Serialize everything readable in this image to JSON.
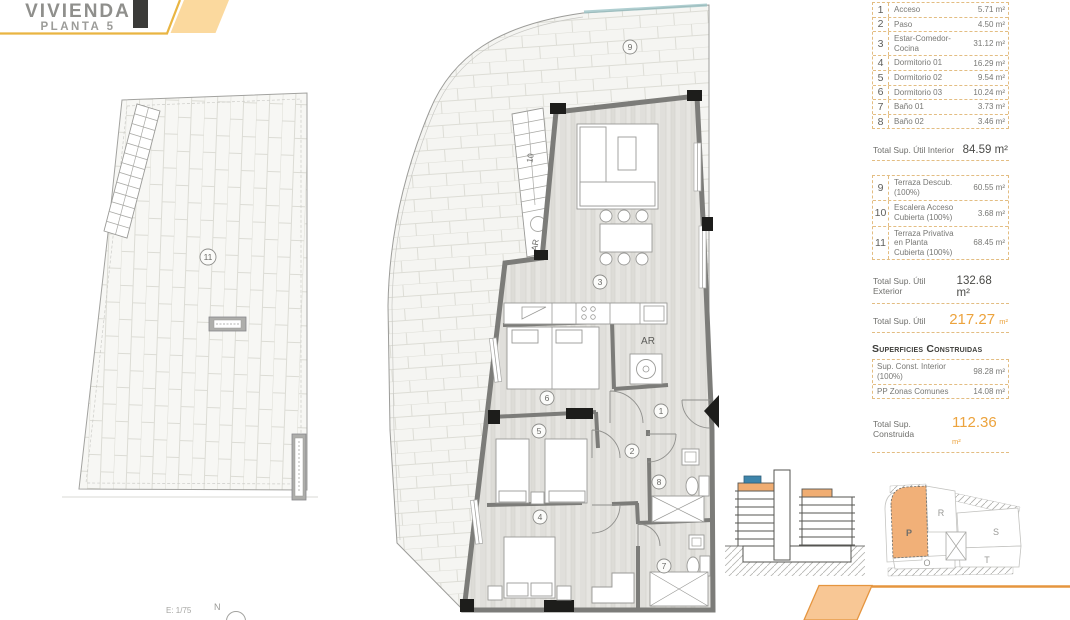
{
  "header": {
    "title": "VIVIENDA",
    "subtitle": "PLANTA 5"
  },
  "footer": {
    "scale_label": "E: 1/75",
    "north_label": "N"
  },
  "colors": {
    "accent_orange": "#E5953F",
    "accent_yellow": "#E9B542",
    "header_fill": "#FBD99E",
    "footer_fill": "#F8C795",
    "table_border": "#E3BD82",
    "totals_orange": "#ECA33D",
    "section_highlight": "#F0AD72",
    "section_blue": "#3E85AB",
    "siteplan_highlight": "#F1B078"
  },
  "plan_labels": {
    "terrace": "9",
    "stair": "10",
    "roof_terrace": "11",
    "living": "3",
    "bedroom3": "6",
    "bedroom2": "5",
    "bedroom1": "4",
    "access": "1",
    "hall": "2",
    "bath1": "7",
    "bath2": "8",
    "closet_main": "AR",
    "closet_stair": "AR"
  },
  "tables": {
    "interior": {
      "rows": [
        {
          "num": "1",
          "label": "Acceso",
          "area": "5.71 m²"
        },
        {
          "num": "2",
          "label": "Paso",
          "area": "4.50 m²"
        },
        {
          "num": "3",
          "label": "Estar-Comedor-Cocina",
          "area": "31.12 m²"
        },
        {
          "num": "4",
          "label": "Dormitorio 01",
          "area": "16.29 m²"
        },
        {
          "num": "5",
          "label": "Dormitorio 02",
          "area": "9.54 m²"
        },
        {
          "num": "6",
          "label": "Dormitorio 03",
          "area": "10.24 m²"
        },
        {
          "num": "7",
          "label": "Baño 01",
          "area": "3.73 m²"
        },
        {
          "num": "8",
          "label": "Baño 02",
          "area": "3.46 m²"
        }
      ],
      "total_label": "Total Sup. Útil Interior",
      "total_value": "84.59 m²"
    },
    "exterior": {
      "rows": [
        {
          "num": "9",
          "label": "Terraza Descub. (100%)",
          "area": "60.55 m²"
        },
        {
          "num": "10",
          "label": "Escalera Acceso Cubierta (100%)",
          "area": "3.68 m²"
        },
        {
          "num": "11",
          "label": "Terraza Privativa en Planta Cubierta (100%)",
          "area": "68.45 m²"
        }
      ],
      "total_label": "Total Sup. Útil Exterior",
      "total_value": "132.68 m²",
      "grand_total_label": "Total Sup. Útil",
      "grand_total_value": "217.27",
      "grand_total_unit": "m²"
    },
    "construidas": {
      "heading": "Superficies Construidas",
      "rows": [
        {
          "label": "Sup. Const. Interior (100%)",
          "area": "98.28 m²"
        },
        {
          "label": "PP Zonas Comunes",
          "area": "14.08 m²"
        }
      ],
      "total_label": "Total Sup. Construida",
      "total_value": "112.36",
      "total_unit": "m²"
    }
  },
  "site_plan": {
    "labels": {
      "o": "O",
      "p": "P",
      "r": "R",
      "s": "S",
      "t": "T"
    },
    "highlighted_block": "P"
  }
}
